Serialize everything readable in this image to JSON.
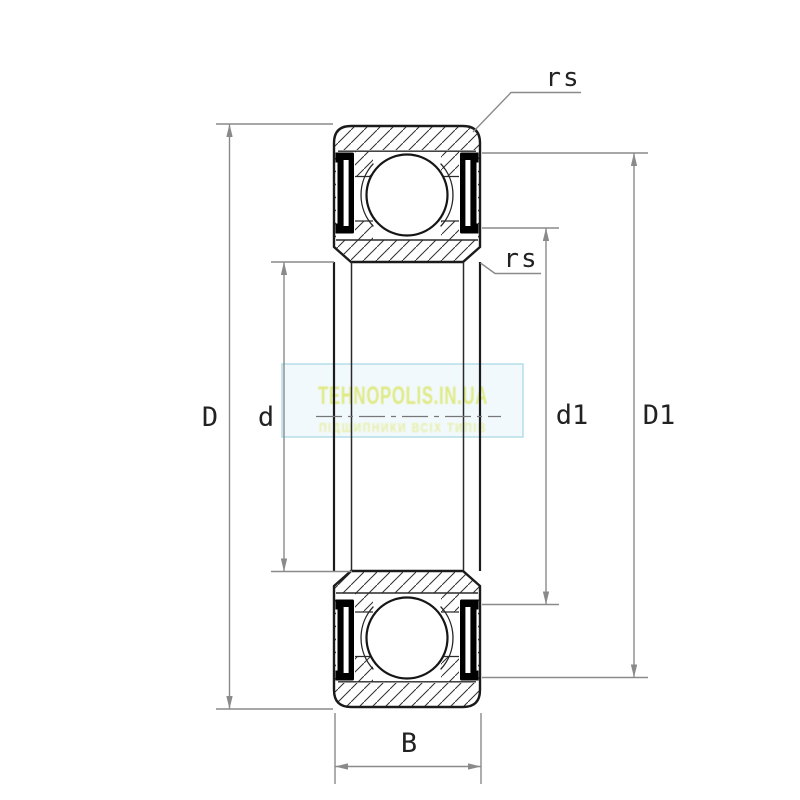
{
  "diagram": {
    "labels": {
      "D": "D",
      "d": "d",
      "d1": "d1",
      "D1": "D1",
      "B": "B",
      "rs_outer": "rs",
      "rs_inner": "rs"
    },
    "colors": {
      "drawing_line": "#1b1b1b",
      "dimension_line": "#8a8a8a",
      "label_text": "#222222",
      "seal_fill": "#000000",
      "hatch_line": "#2e2e2e",
      "background": "#ffffff"
    }
  },
  "watermark": {
    "title": "TEHNOPOLIS.IN.UA",
    "subtitle": "ПІДШИПНИКИ ВСІХ ТИПІВ",
    "title_color": "#dfe97e",
    "subtitle_color": "#e6ec95",
    "box_fill": "#eef8fb",
    "box_border": "#b5dde8"
  }
}
